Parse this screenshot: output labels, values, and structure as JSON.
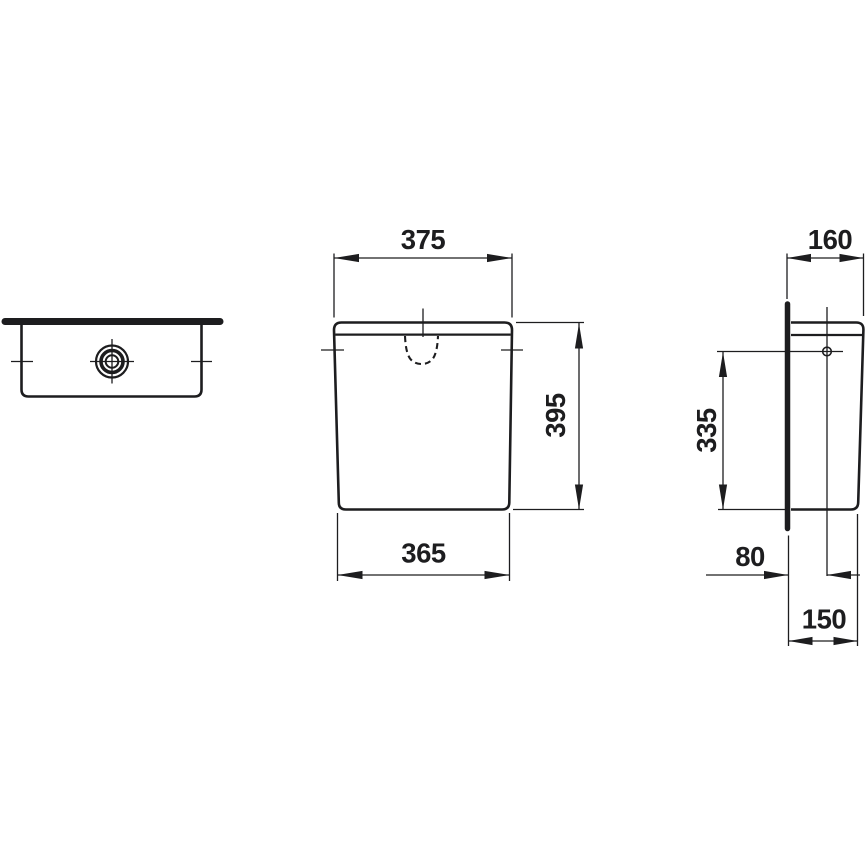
{
  "drawing": {
    "colors": {
      "background": "#ffffff",
      "line": "#1d1d1f"
    },
    "front": {
      "width_top": "375",
      "height": "395",
      "width_bottom": "365"
    },
    "side": {
      "depth_top": "160",
      "inlet_height": "335",
      "wall_to_inlet": "80",
      "depth_bottom": "150"
    }
  }
}
